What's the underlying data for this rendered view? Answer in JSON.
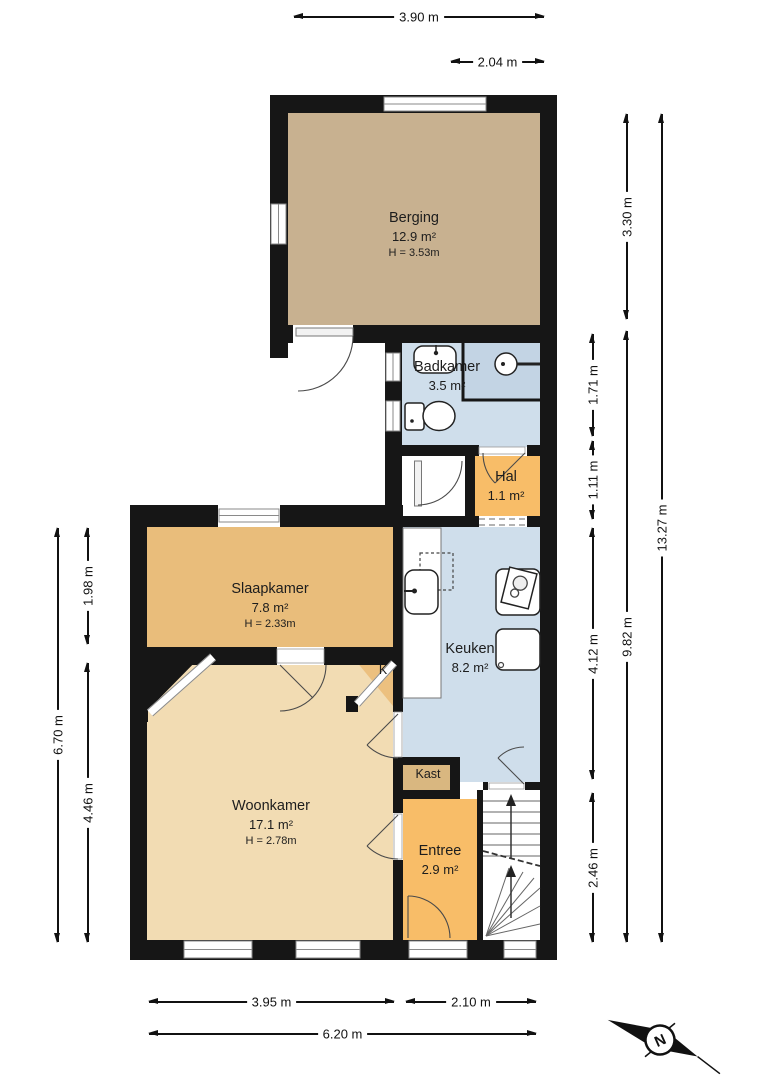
{
  "rooms": {
    "berging": {
      "name": "Berging",
      "area": "12.9 m²",
      "ceiling": "H = 3.53m"
    },
    "badkamer": {
      "name": "Badkamer",
      "area": "3.5 m²"
    },
    "hal": {
      "name": "Hal",
      "area": "1.1 m²"
    },
    "slaapkamer": {
      "name": "Slaapkamer",
      "area": "7.8 m²",
      "ceiling": "H = 2.33m"
    },
    "keuken": {
      "name": "Keuken",
      "area": "8.2 m²"
    },
    "woonkamer": {
      "name": "Woonkamer",
      "area": "17.1 m²",
      "ceiling": "H = 2.78m"
    },
    "kast": {
      "name": "Kast"
    },
    "k_closet": {
      "name": "K"
    },
    "entree": {
      "name": "Entree",
      "area": "2.9 m²"
    }
  },
  "dimensions": {
    "top_full": "3.90 m",
    "top_partial": "2.04 m",
    "bottom_left": "3.95 m",
    "bottom_right": "2.10 m",
    "bottom_full": "6.20 m",
    "left_full": "6.70 m",
    "left_upper": "1.98 m",
    "left_lower": "4.46 m",
    "right_badkamer": "1.71 m",
    "right_hal": "1.11 m",
    "right_keuken": "4.12 m",
    "right_entree": "2.46 m",
    "right_berging": "3.30 m",
    "right_lower": "9.82 m",
    "right_full": "13.27 m"
  },
  "compass": {
    "north_label": "N"
  },
  "colors": {
    "wall": "#161616",
    "berging": "#c8b190",
    "slaapkamer": "#e9bd7b",
    "woonkamer": "#f2dcb3",
    "keuken_badkamer": "#cfdeeb",
    "shower": "#c3d4e4",
    "hal_entree": "#f8bd68",
    "kast": "#d9b780",
    "k_closet": "#ecc07f",
    "background": "#ffffff"
  }
}
